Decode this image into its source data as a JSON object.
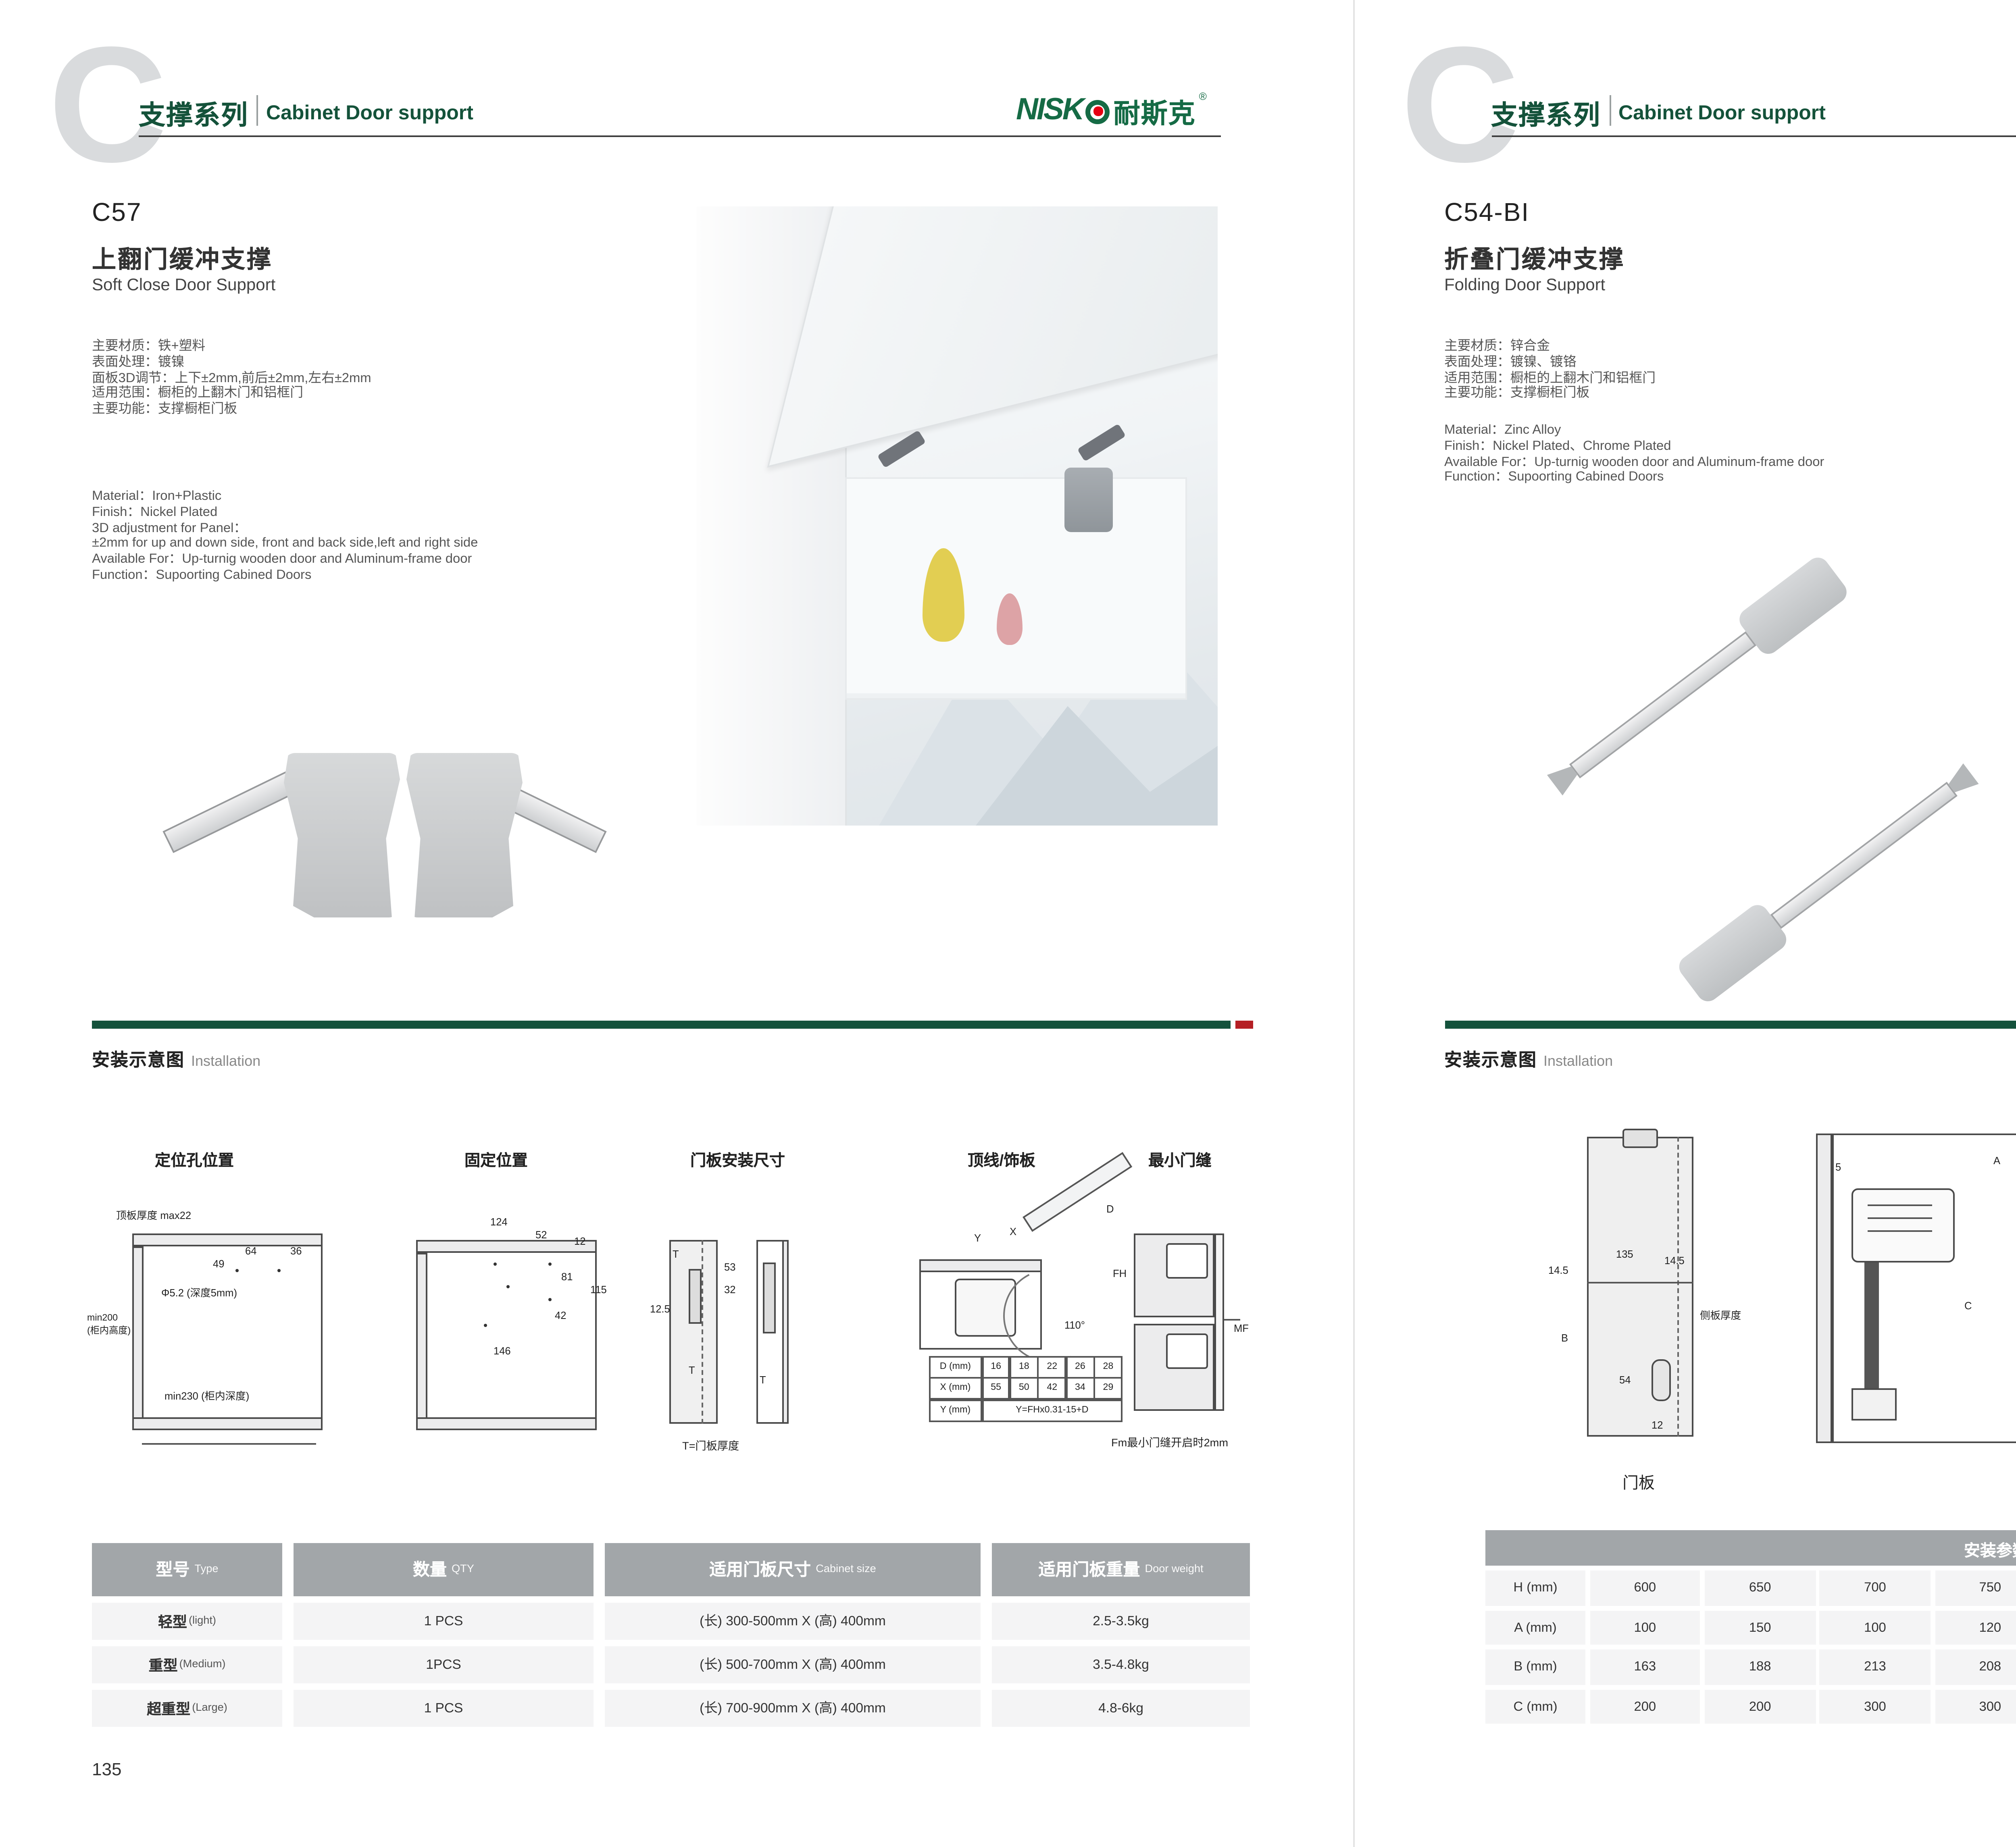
{
  "header": {
    "series_cn": "支撑系列",
    "series_en": "Cabinet Door support",
    "watermark": "C"
  },
  "logo": {
    "text": "NISK",
    "cn": "耐斯克",
    "reg": "®"
  },
  "colors": {
    "brand_green": "#14523c",
    "accent_red": "#b51f24",
    "logo_green": "#156b45",
    "logo_dot_red": "#e60012",
    "table_header_gray": "#a2a6a9"
  },
  "left": {
    "code": "C57",
    "title_cn": "上翻门缓冲支撑",
    "title_en": "Soft Close Door Support",
    "specs_cn": [
      "主要材质：铁+塑料",
      "表面处理：镀镍",
      "面板3D调节：上下±2mm,前后±2mm,左右±2mm",
      "适用范围：橱柜的上翻木门和铝框门",
      "主要功能：支撑橱柜门板"
    ],
    "specs_en": [
      "Material：Iron+Plastic",
      "Finish：Nickel Plated",
      "3D adjustment for Panel：",
      "±2mm for up and down side, front and back side,left and right side",
      "Available For：Up-turnig wooden door and Aluminum-frame door",
      "Function：Supoorting Cabined Doors"
    ],
    "install_cn": "安装示意图",
    "install_en": "Installation",
    "d1": {
      "title": "定位孔位置",
      "top": "顶板厚度 max22",
      "n49": "49",
      "n64": "64",
      "n36": "36",
      "hole": "Φ5.2 (深度5mm)",
      "min200a": "min200",
      "min200b": "(柜内高度)",
      "min230": "min230 (柜内深度)"
    },
    "d2": {
      "title": "固定位置",
      "n124": "124",
      "n52": "52",
      "n12": "12",
      "n81": "81",
      "n115": "115",
      "n42": "42",
      "n146": "146"
    },
    "d3": {
      "title": "门板安装尺寸",
      "t1": "T",
      "n53": "53",
      "n32": "32",
      "n125": "12.5",
      "t2": "T",
      "t3": "T",
      "caption": "T=门板厚度"
    },
    "d4": {
      "title": "顶线/饰板",
      "y": "Y",
      "x": "X",
      "d": "D",
      "fh": "FH",
      "angle": "110°",
      "table": {
        "r1": [
          "D (mm)",
          "16",
          "18",
          "22",
          "26",
          "28"
        ],
        "r2": [
          "X (mm)",
          "55",
          "50",
          "42",
          "34",
          "29"
        ],
        "r3l": "Y (mm)",
        "r3v": "Y=FHx0.31-15+D"
      }
    },
    "d5": {
      "title": "最小门缝",
      "mf": "MF",
      "caption": "Fm最小门缝开启时2mm"
    },
    "table": {
      "h": [
        {
          "cn": "型号",
          "en": "Type"
        },
        {
          "cn": "数量",
          "en": "QTY"
        },
        {
          "cn": "适用门板尺寸",
          "en": "Cabinet size"
        },
        {
          "cn": "适用门板重量",
          "en": "Door weight"
        }
      ],
      "rows": [
        [
          "轻型",
          "(light)",
          "1 PCS",
          "(长) 300-500mm X (高) 400mm",
          "2.5-3.5kg"
        ],
        [
          "重型",
          "(Medium)",
          "1PCS",
          "(长) 500-700mm X (高) 400mm",
          "3.5-4.8kg"
        ],
        [
          "超重型",
          "(Large)",
          "1 PCS",
          "(长) 700-900mm X (高) 400mm",
          "4.8-6kg"
        ]
      ]
    },
    "page": "135"
  },
  "right": {
    "code": "C54-BI",
    "title_cn": "折叠门缓冲支撑",
    "title_en": "Folding Door Support",
    "specs_cn": [
      "主要材质：锌合金",
      "表面处理：镀镍、镀铬",
      "适用范围：橱柜的上翻木门和铝框门",
      "主要功能：支撑橱柜门板"
    ],
    "specs_en": [
      "Material：Zinc Alloy",
      "Finish：Nickel Plated、Chrome Plated",
      "Available For：Up-turnig wooden door and Aluminum-frame door",
      "Function：Supoorting Cabined Doors"
    ],
    "install_cn": "安装示意图",
    "install_en": "Installation",
    "d1": {
      "n135": "135",
      "l145": "14.5",
      "r145": "14.5",
      "b": "B",
      "side": "侧板厚度",
      "n54": "54",
      "n12": "12",
      "caption": "门板"
    },
    "d2": {
      "n5": "5",
      "a": "A",
      "n19": "19",
      "c": "C"
    },
    "d3": {
      "n193": "193",
      "n102": "102",
      "n23": "23",
      "h": "H",
      "n50": "50"
    },
    "d4": {
      "n24": "24",
      "n12": "12"
    },
    "table": {
      "title_cn": "安装参数",
      "title_en": "Reference Data",
      "labels": [
        "H (mm)",
        "A (mm)",
        "B (mm)",
        "C (mm)"
      ],
      "rows": [
        [
          "600",
          "650",
          "700",
          "750",
          "800",
          "850",
          "900",
          "950",
          "1000"
        ],
        [
          "100",
          "150",
          "100",
          "120",
          "200",
          "250",
          "200",
          "250",
          "250"
        ],
        [
          "163",
          "188",
          "213",
          "208",
          "263",
          "288",
          "263",
          "288",
          "313"
        ],
        [
          "200",
          "200",
          "300",
          "300",
          "300",
          "300",
          "350",
          "350",
          "400"
        ]
      ]
    },
    "page": "136"
  }
}
